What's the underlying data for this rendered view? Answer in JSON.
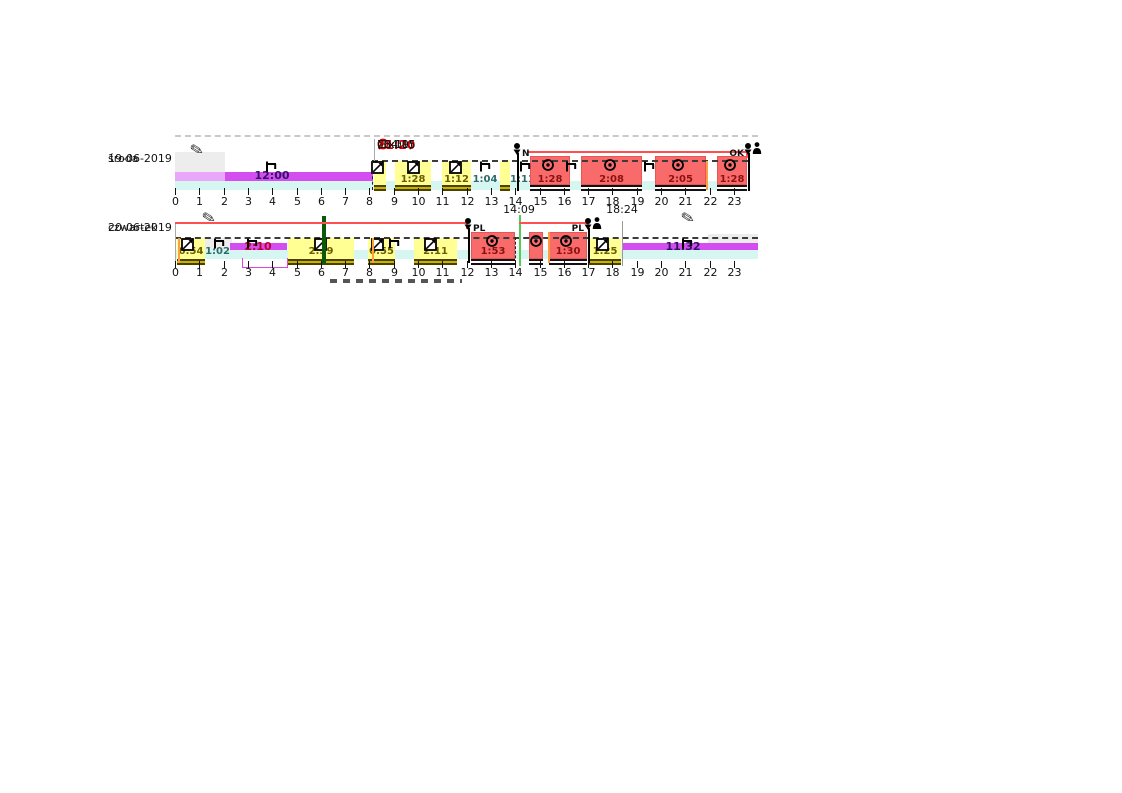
{
  "colors": {
    "background": "#FFFFFF",
    "work_fill": "#FFFF94",
    "work_text": "#6B5D00",
    "drive_fill": "#F96B6B",
    "drive_border": "#E85555",
    "drive_text": "#8B1111",
    "rest_fill": "#D44DF0",
    "rest_text": "#331166",
    "rest_alert_text": "#C00030",
    "break_text": "#2E6B6B",
    "availability_fill": "#D5F6F1",
    "gray_block": "#EDEDED",
    "overline": "#FF5050",
    "alert": "#CC0000",
    "orange_line": "#FFA040",
    "green_dark": "#0A5A0A",
    "green_light": "#55CC55"
  },
  "layout": {
    "x0": 175,
    "hour_width": 24.3,
    "rows_y": [
      {
        "overline": 151,
        "dash": 160,
        "work_top": 161,
        "drive_top": 156,
        "bottom": 185,
        "rest_top": 172,
        "rest_h": 9,
        "cyan_top": 181,
        "cyan_h": 9,
        "trace_top": 185,
        "tick_top": 188,
        "tick_label": 196,
        "icon_y": 161,
        "drive_icon_y": 158,
        "label_y": 174,
        "day_y": 150,
        "marker_top": 143,
        "marker_text_y": 149,
        "marker_line_end": 191
      },
      {
        "overline": 222,
        "dash": 237,
        "work_top": 238,
        "drive_top": 232,
        "bottom": 259,
        "rest_top": 243,
        "rest_h": 9,
        "cyan_top": 250,
        "cyan_h": 9,
        "trace_top": 259,
        "tick_top": 261,
        "tick_label": 267,
        "icon_y": 238,
        "drive_icon_y": 234,
        "label_y": 246,
        "day_y": 219,
        "marker_top": 218,
        "marker_text_y": 224,
        "marker_line_end": 263,
        "time_label_y": 204
      }
    ]
  },
  "chart_data": {
    "type": "bar",
    "title": "Tachograph driver activity timeline",
    "x_axis": {
      "range_hours": [
        0,
        24
      ],
      "ticks": [
        "0",
        "1",
        "2",
        "3",
        "4",
        "5",
        "6",
        "7",
        "8",
        "9",
        "10",
        "11",
        "12",
        "13",
        "14",
        "15",
        "16",
        "17",
        "18",
        "19",
        "20",
        "21",
        "22",
        "23"
      ]
    },
    "legend": {
      "driving": "red blocks",
      "other_work": "yellow blocks",
      "rest": "magenta bar",
      "availability": "cyan band"
    },
    "rows": [
      {
        "day": "środa",
        "date": "19-06-2019",
        "summary": {
          "shift_start": "08:09",
          "driving_time": "11:20",
          "extension": "(1x10)",
          "total": "Σ34:15"
        },
        "segments": [
          {
            "activity": "rest",
            "start": 0,
            "end": 8.15,
            "label": "12:00",
            "label_hour": 4.0,
            "light_until": 2.05
          },
          {
            "activity": "work",
            "start": 8.18,
            "end": 8.68,
            "label": ""
          },
          {
            "activity": "work",
            "start": 9.05,
            "end": 10.55,
            "label": "1:28"
          },
          {
            "activity": "work",
            "start": 11.0,
            "end": 12.2,
            "label": "1:12"
          },
          {
            "activity": "break",
            "start": 12.2,
            "end": 13.35,
            "label": "1:04"
          },
          {
            "activity": "work",
            "start": 13.38,
            "end": 13.78,
            "label": ""
          },
          {
            "activity": "break",
            "start": 13.8,
            "end": 14.45,
            "label": "1:11"
          },
          {
            "activity": "driving",
            "start": 14.6,
            "end": 16.25,
            "label": "1:28"
          },
          {
            "activity": "driving",
            "start": 16.7,
            "end": 19.2,
            "label": "2:08"
          },
          {
            "activity": "driving",
            "start": 19.75,
            "end": 21.85,
            "label": "2:05"
          },
          {
            "activity": "driving",
            "start": 22.3,
            "end": 23.55,
            "label": "1:28"
          }
        ],
        "icons": [
          {
            "type": "rest",
            "hour": 4.0
          },
          {
            "type": "work",
            "hour": 8.35
          },
          {
            "type": "work",
            "hour": 9.85
          },
          {
            "type": "work",
            "hour": 11.55
          },
          {
            "type": "rest",
            "hour": 12.8
          },
          {
            "type": "rest",
            "hour": 14.45
          },
          {
            "type": "drive",
            "hour": 15.35
          },
          {
            "type": "rest",
            "hour": 16.35
          },
          {
            "type": "drive",
            "hour": 17.9
          },
          {
            "type": "rest",
            "hour": 19.55
          },
          {
            "type": "drive",
            "hour": 20.7
          },
          {
            "type": "drive",
            "hour": 22.85
          }
        ],
        "markers": [
          {
            "type": "card-insert",
            "hour": 14.07,
            "text": "N",
            "side": "right",
            "person": false
          },
          {
            "type": "card-eject",
            "hour": 23.6,
            "text": "OK",
            "side": "left",
            "person": true
          }
        ],
        "gray_blocks": [
          {
            "start": 0,
            "end": 2.05,
            "y1": 152,
            "y2": 172
          }
        ],
        "pencils": [
          {
            "hour": 0.95,
            "y": 142
          }
        ],
        "overlines": [
          {
            "from": 14.5,
            "to": 23.6
          }
        ],
        "dashed_span": {
          "from": 8.1,
          "to": 23.6
        },
        "cyan_span": {
          "from": 0,
          "to": 23.55
        },
        "vlines": [
          {
            "hour": 8.2,
            "color": "#AAAAAA",
            "width": 1,
            "y1": 139,
            "y2": 161,
            "dashed": false
          },
          {
            "hour": 8.1,
            "color": "#222222",
            "width": 1,
            "y1": 160,
            "y2": 190,
            "dashed": true
          },
          {
            "hour": 21.85,
            "color": "#FFA040",
            "width": 2,
            "y1": 161,
            "y2": 190,
            "dashed": false
          },
          {
            "hour": 23.58,
            "color": "#333333",
            "width": 1,
            "y1": 158,
            "y2": 191,
            "dashed": false
          }
        ]
      },
      {
        "day": "czwartek",
        "date": "20-06-2019",
        "summary": null,
        "segments": [
          {
            "activity": "work",
            "start": 0.1,
            "end": 1.25,
            "label": "0:54"
          },
          {
            "activity": "break",
            "start": 1.2,
            "end": 2.3,
            "label": "1:02"
          },
          {
            "activity": "rest",
            "start": 2.25,
            "end": 4.6,
            "label": "2:10",
            "label_hour": 3.4,
            "alert": true
          },
          {
            "activity": "work",
            "start": 4.65,
            "end": 7.35,
            "label": "2:39"
          },
          {
            "activity": "work",
            "start": 7.95,
            "end": 9.05,
            "label": "0:55"
          },
          {
            "activity": "work",
            "start": 9.85,
            "end": 11.6,
            "label": "2:11"
          },
          {
            "activity": "driving",
            "start": 12.2,
            "end": 14.0,
            "label": "1:53"
          },
          {
            "activity": "driving",
            "start": 14.55,
            "end": 15.15,
            "label": ""
          },
          {
            "activity": "driving",
            "start": 15.4,
            "end": 16.95,
            "label": "1:30"
          },
          {
            "activity": "work",
            "start": 17.05,
            "end": 18.35,
            "label": "1:25"
          },
          {
            "activity": "rest",
            "start": 18.4,
            "end": 24,
            "label": "11:32",
            "label_hour": 20.9
          }
        ],
        "icons": [
          {
            "type": "work",
            "hour": 0.55
          },
          {
            "type": "rest",
            "hour": 1.85
          },
          {
            "type": "rest",
            "hour": 3.2
          },
          {
            "type": "work",
            "hour": 6.0
          },
          {
            "type": "work",
            "hour": 8.35
          },
          {
            "type": "rest",
            "hour": 9.05
          },
          {
            "type": "work",
            "hour": 10.55
          },
          {
            "type": "drive",
            "hour": 13.05
          },
          {
            "type": "drive",
            "hour": 14.85
          },
          {
            "type": "drive",
            "hour": 16.1
          },
          {
            "type": "work",
            "hour": 17.6
          },
          {
            "type": "rest",
            "hour": 21.1
          }
        ],
        "markers": [
          {
            "type": "card-insert",
            "hour": 12.05,
            "text": "PL",
            "side": "right",
            "person": false
          },
          {
            "type": "card-eject",
            "hour": 17.0,
            "text": "PL",
            "side": "left",
            "person": true
          }
        ],
        "gray_blocks": [
          {
            "start": 1.25,
            "end": 2.35,
            "y1": 238,
            "y2": 258
          },
          {
            "start": 21.95,
            "end": 24,
            "y1": 234,
            "y2": 256
          }
        ],
        "pencils": [
          {
            "hour": 1.45,
            "y": 210
          },
          {
            "hour": 21.15,
            "y": 210
          }
        ],
        "overlines": [
          {
            "from": 0,
            "to": 12.05
          },
          {
            "from": 14.17,
            "to": 17.05
          }
        ],
        "dashed_span": {
          "from": 0,
          "to": 24
        },
        "cyan_span": {
          "from": 0,
          "to": 24
        },
        "time_labels": [
          {
            "hour": 14.15,
            "text": "14:09"
          },
          {
            "hour": 18.4,
            "text": "18:24"
          }
        ],
        "bracket": {
          "from": 2.75,
          "to": 4.65,
          "y1": 258,
          "y2": 268,
          "color": "#DD44DD"
        },
        "vlines": [
          {
            "hour": 0.02,
            "color": "#AAAAAA",
            "width": 1,
            "y1": 222,
            "y2": 268,
            "dashed": false
          },
          {
            "hour": 0.12,
            "color": "#FFA040",
            "width": 2,
            "y1": 238,
            "y2": 263,
            "dashed": false
          },
          {
            "hour": 6.05,
            "color": "#0A5A0A",
            "width": 4,
            "y1": 216,
            "y2": 264,
            "dashed": false
          },
          {
            "hour": 8.12,
            "color": "#FFA040",
            "width": 2,
            "y1": 238,
            "y2": 263,
            "dashed": false
          },
          {
            "hour": 14.0,
            "color": "#222222",
            "width": 1,
            "y1": 237,
            "y2": 263,
            "dashed": true
          },
          {
            "hour": 14.17,
            "color": "#55CC55",
            "width": 2,
            "y1": 215,
            "y2": 266,
            "dashed": false
          },
          {
            "hour": 15.33,
            "color": "#FFA040",
            "width": 2,
            "y1": 232,
            "y2": 263,
            "dashed": false
          },
          {
            "hour": 18.4,
            "color": "#999999",
            "width": 1,
            "y1": 221,
            "y2": 266,
            "dashed": false
          }
        ]
      }
    ]
  }
}
